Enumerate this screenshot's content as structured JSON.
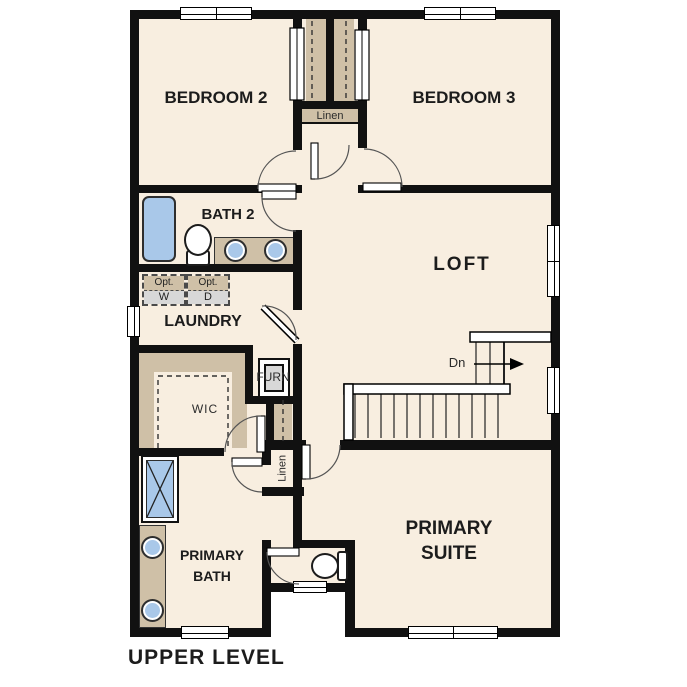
{
  "title": "UPPER LEVEL",
  "rooms": {
    "bedroom2": "BEDROOM 2",
    "bedroom3": "BEDROOM 3",
    "bath2": "BATH 2",
    "loft": "LOFT",
    "laundry": "LAUNDRY",
    "wic": "WIC",
    "primary_bath": "PRIMARY BATH",
    "primary_suite": "PRIMARY SUITE"
  },
  "closets": {
    "linen_upper": "Linen",
    "linen_lower": "Linen"
  },
  "equipment": {
    "furnace": "FURN",
    "washer": {
      "label": "Opt.",
      "letter": "W"
    },
    "dryer": {
      "label": "Opt.",
      "letter": "D"
    }
  },
  "stairs": {
    "direction": "Dn"
  },
  "colors": {
    "wall": "#111111",
    "floor": "#f8eee0",
    "casework_tan": "#cfc0a7",
    "fixture_blue": "#a9c8e9",
    "appliance_gray": "#d8d8d8"
  }
}
